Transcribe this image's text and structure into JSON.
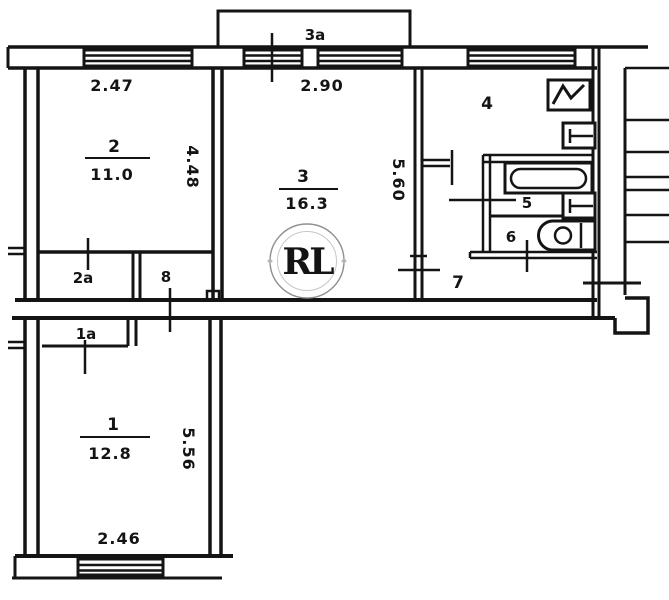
{
  "watermark": {
    "text": "RL"
  },
  "rooms": {
    "room1": {
      "number": "1",
      "area": "12.8",
      "width": "2.46",
      "height": "5.56"
    },
    "room2": {
      "number": "2",
      "area": "11.0",
      "width": "2.47",
      "height": "4.48"
    },
    "room3": {
      "number": "3",
      "area": "16.3",
      "width": "2.90",
      "height": "5.60"
    },
    "kitchen": {
      "number": "4"
    },
    "bathroom": {
      "number": "5"
    },
    "toilet": {
      "number": "6"
    },
    "hallway": {
      "number": "7"
    },
    "closet_2a": {
      "label": "2a"
    },
    "hall_8": {
      "label": "8"
    },
    "closet_1a": {
      "label": "1a"
    },
    "balcony": {
      "label": "3a"
    }
  },
  "colors": {
    "line": "#141414",
    "gold_light": "#ecd27c",
    "gold_mid": "#c9a13b",
    "gold_dark": "#8a671a",
    "ring_gray": "#9a9a9a"
  }
}
